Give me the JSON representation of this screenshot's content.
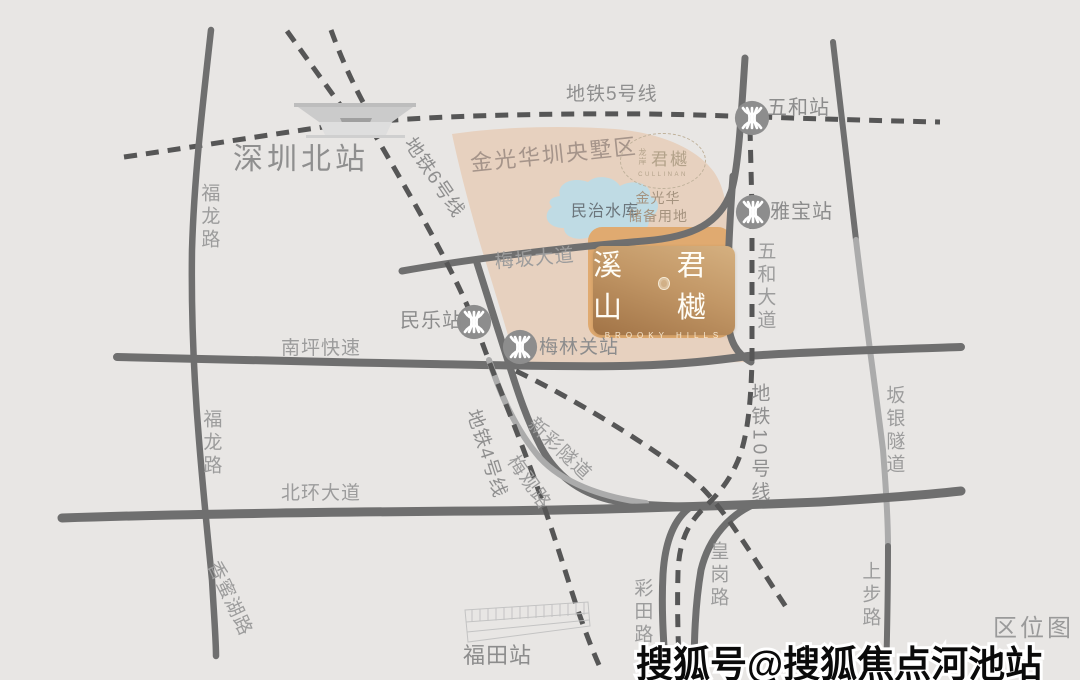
{
  "map_title": "区位图",
  "watermark": "搜狐号@搜狐焦点河池站",
  "stations": {
    "shenzhen_north": "深圳北站",
    "wuhe": "五和站",
    "yabao": "雅宝站",
    "minle": "民乐站",
    "meilinguan": "梅林关站",
    "futian": "福田站"
  },
  "metro_lines": {
    "line5": "地铁5号线",
    "line6": "地铁6号线",
    "line4": "地铁4号线",
    "line10": "地铁10号线"
  },
  "roads": {
    "fulong_north": "福龙路",
    "fulong_south": "福龙路",
    "xiangmihu": "香蜜湖路",
    "nanping": "南坪快速",
    "beihuan": "北环大道",
    "meiban": "梅坂大道",
    "wuhe_avenue": "五和大道",
    "meiguan": "梅观路",
    "xincai_tunnel": "新彩隧道",
    "caitian": "彩田路",
    "huanggang": "皇岗路",
    "banyin_tunnel": "坂银隧道",
    "shangbu": "上步路"
  },
  "areas": {
    "district": "金光华圳央墅区",
    "reserve_line1": "金光华",
    "reserve_line2": "储备用地",
    "lake": "民治水库"
  },
  "badge": {
    "prefix": "龙岸",
    "name": "君樾",
    "subtitle": "CULLINAN"
  },
  "project": {
    "name_left": "溪山",
    "name_right": "君樾",
    "subtitle": "BROOKY HILLS"
  },
  "colors": {
    "background": "#e8e6e4",
    "road": "#6f6f6f",
    "road_light": "#ababab",
    "metro_dash": "#565656",
    "district_fill": "#e7d1bf",
    "site_fill": "#e0aa70",
    "lake_fill": "#bfdbe4",
    "card_gold_light": "#d5b080",
    "card_gold_dark": "#a17346",
    "label_gray": "#9c9c9c",
    "watermark_color": "#0a0a0a"
  }
}
